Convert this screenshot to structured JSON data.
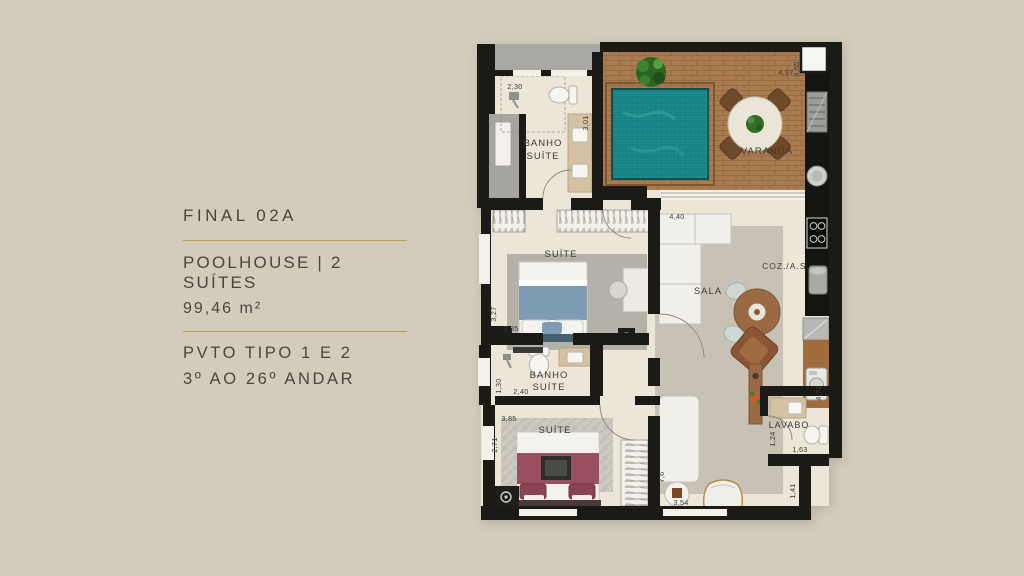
{
  "info_panel": {
    "unit_label": "FINAL 02A",
    "title": "POOLHOUSE | 2 SUÍTES",
    "area": "99,46 m²",
    "pavement": "PVTO TIPO 1 E 2",
    "floors": "3º AO 26º ANDAR",
    "text_color": "#4a463e",
    "divider_color": "#b3a04a"
  },
  "floor_plan": {
    "rooms": {
      "banho_suite_1": {
        "label_line1": "BANHO",
        "label_line2": "SUÍTE"
      },
      "varanda": {
        "label": "VARANDA"
      },
      "suite_1": {
        "label": "SUÍTE"
      },
      "sala": {
        "label": "SALA"
      },
      "cozinha_as": {
        "label": "COZ./A.S."
      },
      "banho_suite_2": {
        "label_line1": "BANHO",
        "label_line2": "SUÍTE"
      },
      "suite_2": {
        "label": "SUÍTE"
      },
      "lavabo": {
        "label": "LAVABO"
      }
    },
    "dimensions": {
      "banho1_width": "2,30",
      "banho1_depth": "3,01",
      "varanda_width": "4,97",
      "varanda_depth": "3,55",
      "sala_width": "4,40",
      "suite1_depth": "3,27",
      "suite1_width": "3,85",
      "banho2_depth": "1,30",
      "banho2_width": "2,40",
      "suite2_width": "3,85",
      "suite2_depth": "2,71",
      "sala_depth": "7,6",
      "sala_bottom_width": "3,54",
      "servico_depth": "4,72",
      "lavabo_depth": "1,24",
      "lavabo_width": "1,63",
      "recess_depth": "1,41"
    },
    "colors": {
      "background": "#d3cbbc",
      "wall": "#1b1a17",
      "floor": "#ece6d8",
      "wood_deck": "#a87c50",
      "pool_water": "#1e8d8f",
      "corridor_gray": "#a9a8a3",
      "rug_sala": "#c8c2b6",
      "rug_suite1": "#b4b1a9",
      "rug_suite2": "#cdc9c1",
      "bed_suite1": "#7e9cb2",
      "bed_suite2": "#99505e",
      "service_counter": "#a06c3e",
      "label_text": "#3c3a33"
    }
  }
}
